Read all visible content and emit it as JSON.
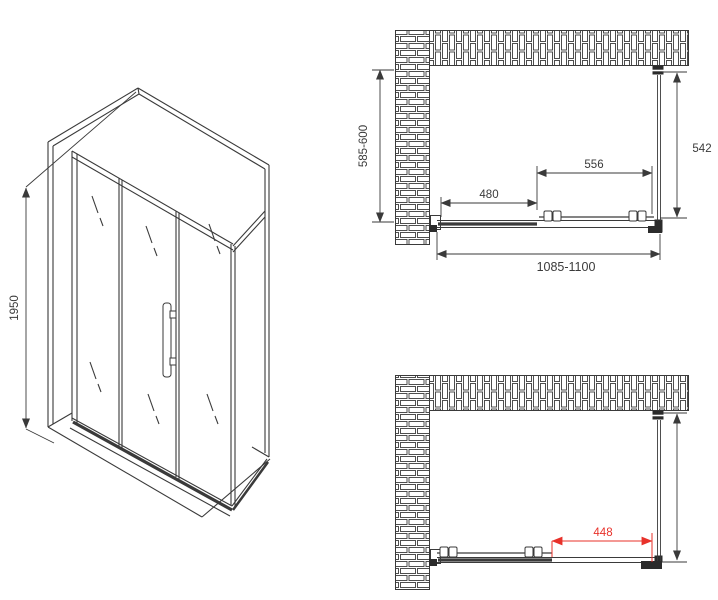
{
  "iso_view": {
    "height_dim": "1950"
  },
  "top_view": {
    "depth_range_dim": "585-600",
    "side_panel_dim": "542",
    "door_dim": "556",
    "fixed_panel_dim": "480",
    "width_range_dim": "1085-1100"
  },
  "open_view": {
    "opening_dim": "448"
  },
  "colors": {
    "line": "#3a3a3a",
    "dimension_red": "#e8312a",
    "background": "#ffffff"
  }
}
